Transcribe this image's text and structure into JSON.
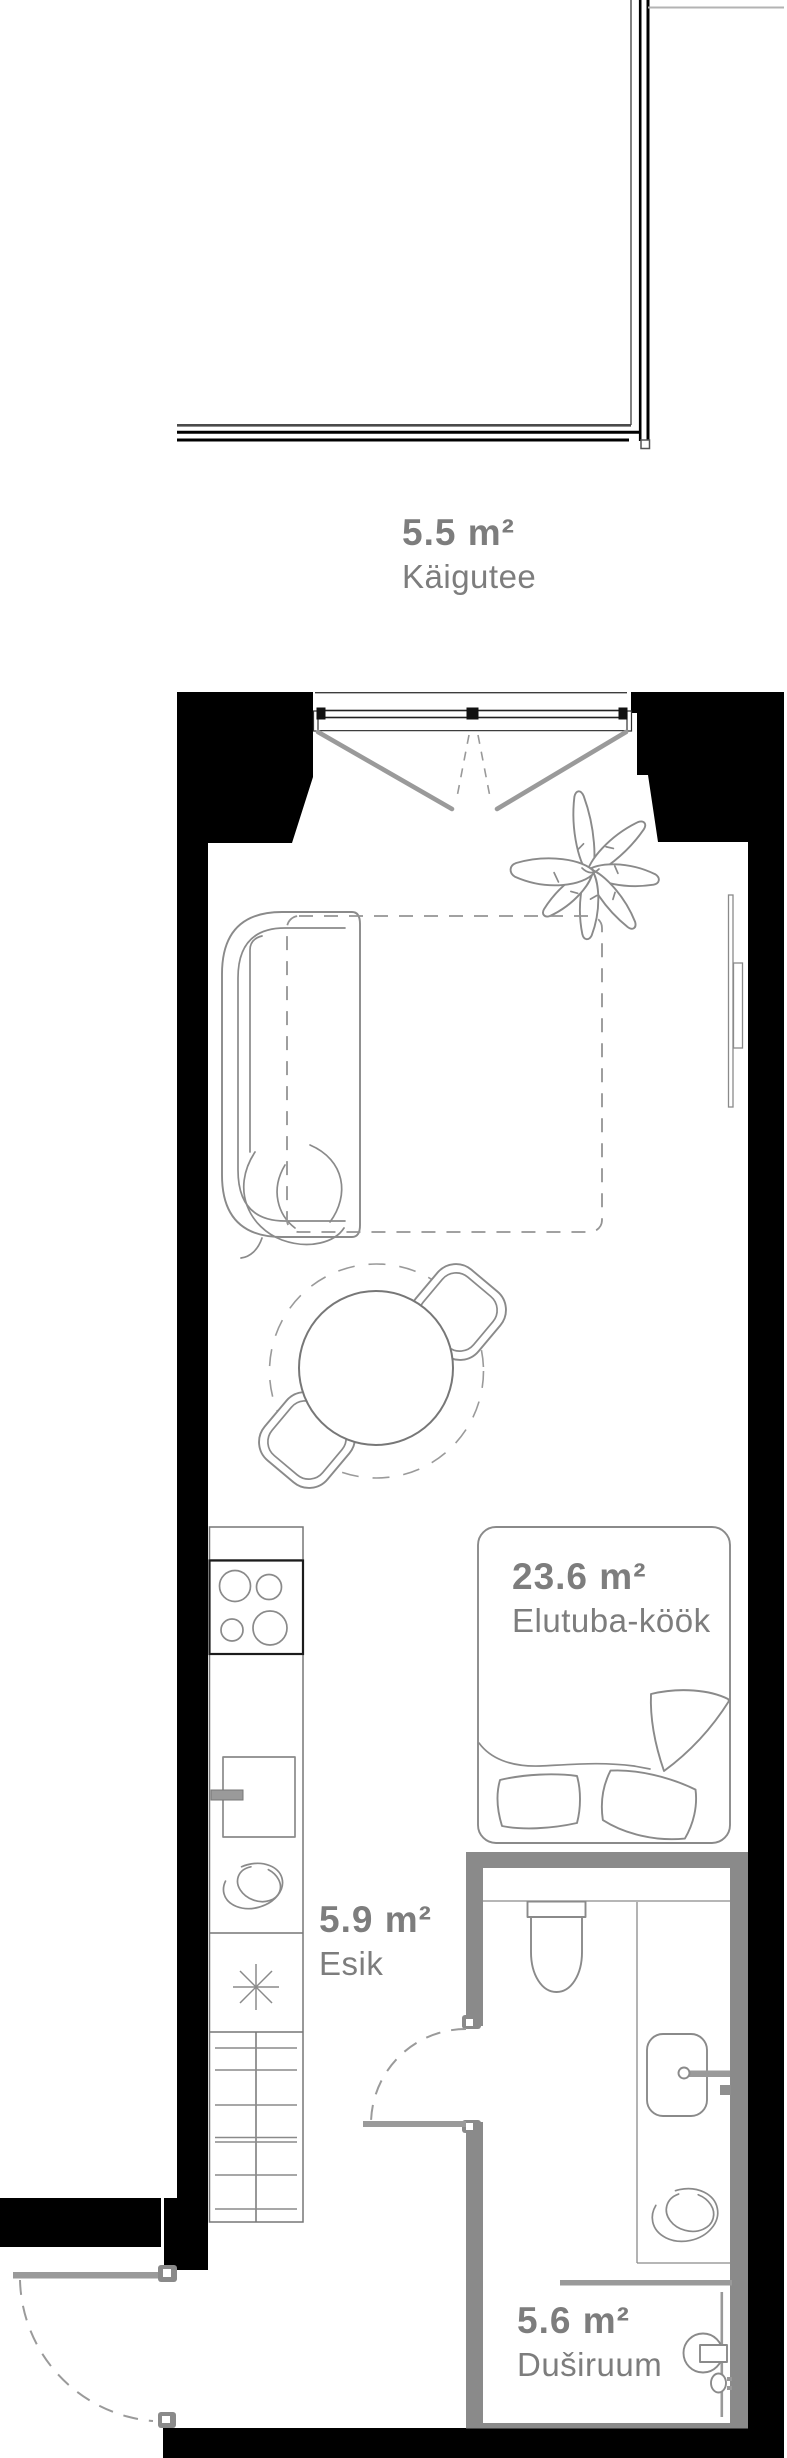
{
  "document_title": "Apartment floor plan",
  "colors": {
    "wall": "#000000",
    "wet-wall": "#8a8a8a",
    "furniture": "#8a8a8a",
    "label": "#7d7d7d",
    "door": "#9a9a9a"
  },
  "rooms": [
    {
      "id": "kaigutee",
      "area": "5.5 m²",
      "name": "Käigutee"
    },
    {
      "id": "elutuba",
      "area": "23.6 m²",
      "name": "Elutuba-köök"
    },
    {
      "id": "esik",
      "area": "5.9 m²",
      "name": "Esik"
    },
    {
      "id": "dusiruum",
      "area": "5.6 m²",
      "name": "Duširuum"
    }
  ]
}
